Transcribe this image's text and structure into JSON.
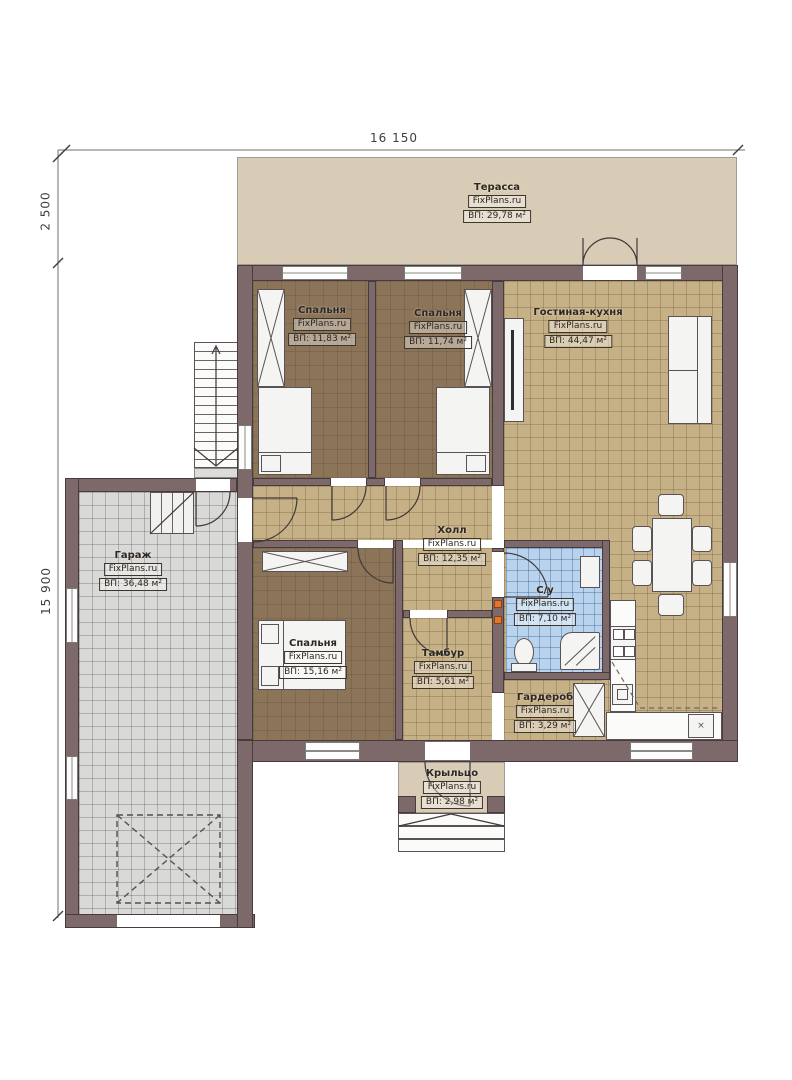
{
  "plan": {
    "dimensions": {
      "overall_width": "16 150",
      "terrace_depth": "2 500",
      "overall_height": "15 900"
    },
    "rooms": {
      "terrace": {
        "name": "Терасса",
        "brand": "FixPlans.ru",
        "area": "ВП: 29,78 м²"
      },
      "bedroom_top_left": {
        "name": "Спальня",
        "brand": "FixPlans.ru",
        "area": "ВП: 11,83 м²"
      },
      "bedroom_top_right": {
        "name": "Спальня",
        "brand": "FixPlans.ru",
        "area": "ВП: 11,74 м²"
      },
      "living_kitchen": {
        "name": "Гостиная-кухня",
        "brand": "FixPlans.ru",
        "area": "ВП: 44,47 м²"
      },
      "garage": {
        "name": "Гараж",
        "brand": "FixPlans.ru",
        "area": "ВП: 36,48 м²"
      },
      "hall": {
        "name": "Холл",
        "brand": "FixPlans.ru",
        "area": "ВП: 12,35 м²"
      },
      "bathroom": {
        "name": "С/у",
        "brand": "FixPlans.ru",
        "area": "ВП: 7,10 м²"
      },
      "bedroom_bottom": {
        "name": "Спальня",
        "brand": "FixPlans.ru",
        "area": "ВП: 15,16 м²"
      },
      "tambour": {
        "name": "Тамбур",
        "brand": "FixPlans.ru",
        "area": "ВП: 5,61 м²"
      },
      "wardrobe": {
        "name": "Гардероб",
        "brand": "FixPlans.ru",
        "area": "ВП: 3,29 м²"
      },
      "porch": {
        "name": "Крыльцо",
        "brand": "FixPlans.ru",
        "area": "ВП: 2,98 м²"
      }
    },
    "fixtures": {
      "sink_marker": "×"
    },
    "colors": {
      "wall": "#7d686a",
      "wall_edge": "#463c3e",
      "terrace_floor": "#d8ccb6",
      "tile_floor": "#c6b187",
      "bedroom_floor": "#8c7459",
      "garage_floor": "#d9d9d7",
      "bath_floor": "#b9d3ec",
      "switch_accent": "#e2762f",
      "line": "#40383a"
    }
  }
}
